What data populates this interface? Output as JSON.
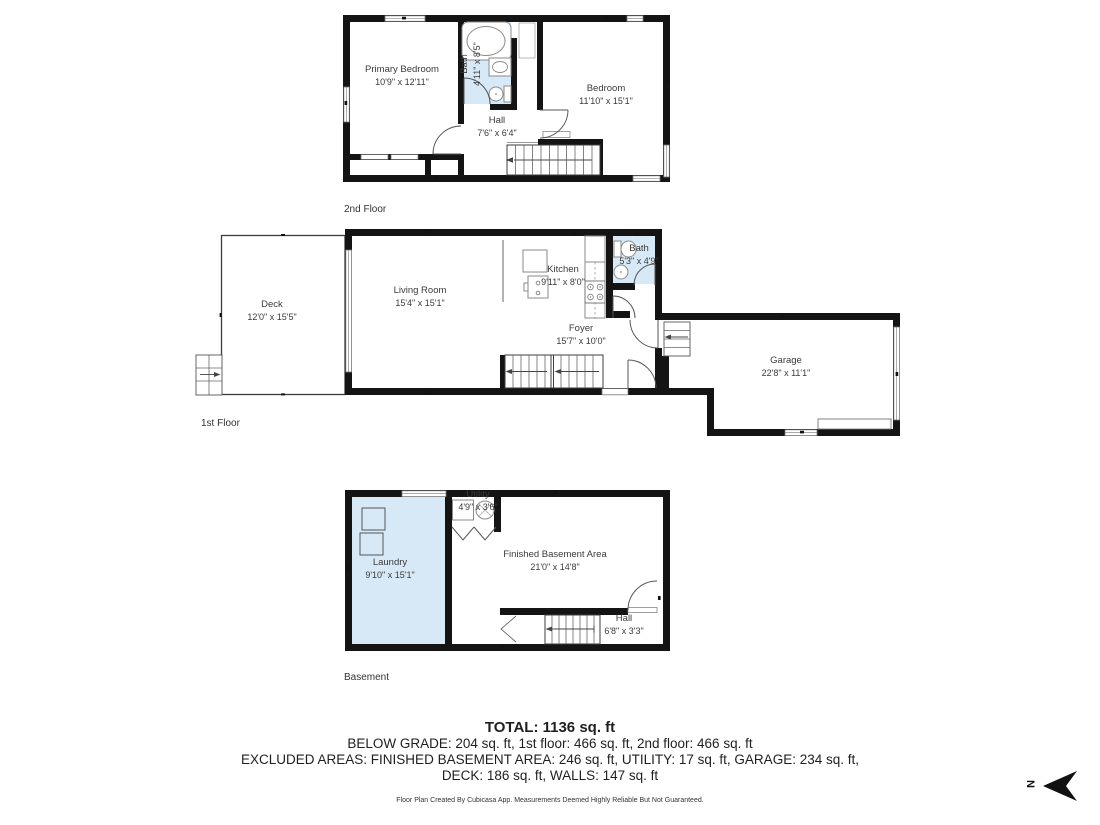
{
  "floors": [
    {
      "label": "2nd Floor",
      "rooms": {
        "primary_bedroom": {
          "name": "Primary Bedroom",
          "dims": "10'9\" x 12'11\""
        },
        "bath": {
          "name": "Bath",
          "dims": "4'11\" x 8'5\""
        },
        "bedroom": {
          "name": "Bedroom",
          "dims": "11'10\" x 15'1\""
        },
        "hall": {
          "name": "Hall",
          "dims": "7'6\" x 6'4\""
        }
      }
    },
    {
      "label": "1st Floor",
      "rooms": {
        "deck": {
          "name": "Deck",
          "dims": "12'0\" x 15'5\""
        },
        "living_room": {
          "name": "Living Room",
          "dims": "15'4\" x 15'1\""
        },
        "kitchen": {
          "name": "Kitchen",
          "dims": "9'11\" x 8'0\""
        },
        "bath": {
          "name": "Bath",
          "dims": "5'3\" x 4'9\""
        },
        "foyer": {
          "name": "Foyer",
          "dims": "15'7\" x 10'0\""
        },
        "garage": {
          "name": "Garage",
          "dims": "22'8\" x 11'1\""
        }
      }
    },
    {
      "label": "Basement",
      "rooms": {
        "laundry": {
          "name": "Laundry",
          "dims": "9'10\" x 15'1\""
        },
        "utility": {
          "name": "Utility",
          "dims": "4'9\" x 3'6\""
        },
        "finished_basement": {
          "name": "Finished Basement Area",
          "dims": "21'0\" x 14'8\""
        },
        "hall": {
          "name": "Hall",
          "dims": "6'8\" x 3'3\""
        }
      }
    }
  ],
  "summary": {
    "total": "TOTAL: 1136 sq. ft",
    "below_grade_line": "BELOW GRADE: 204 sq. ft, 1st floor: 466 sq. ft, 2nd floor: 466 sq. ft",
    "excluded_line_1": "EXCLUDED AREAS: FINISHED BASEMENT AREA: 246 sq. ft, UTILITY: 17 sq. ft, GARAGE: 234 sq. ft,",
    "excluded_line_2": "DECK: 186 sq. ft, WALLS: 147 sq. ft",
    "disclaimer": "Floor Plan Created By Cubicasa App. Measurements Deemed Highly Reliable But Not Guaranteed."
  },
  "compass": {
    "letter": "N"
  },
  "colors": {
    "wall": "#141414",
    "wet_room_fill": "#d7e9f7",
    "label_text": "#3a3a3a"
  }
}
